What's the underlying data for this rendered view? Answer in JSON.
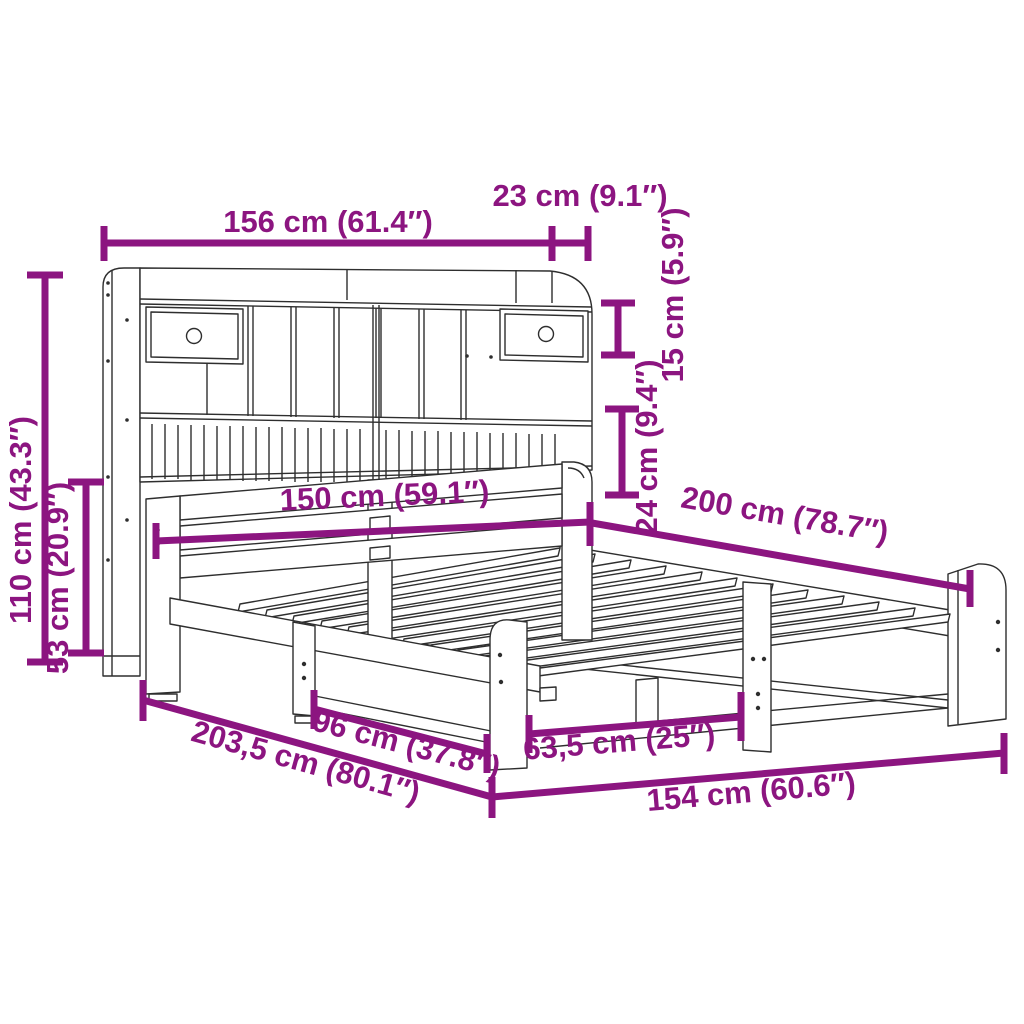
{
  "colors": {
    "accent": "#8C1580",
    "line_art": "#2E2E2E",
    "background": "#FFFFFF"
  },
  "diagram": {
    "dimensions": {
      "headboard_width": {
        "label": "156 cm (61.4″)"
      },
      "headboard_top_depth": {
        "label": "23 cm (9.1″)"
      },
      "top_shelf_height": {
        "label": "15 cm (5.9″)"
      },
      "mid_shelf_height": {
        "label": "24 cm (9.4″)"
      },
      "total_height": {
        "label": "110 cm (43.3″)"
      },
      "lower_height": {
        "label": "53 cm (20.9″)"
      },
      "bed_width": {
        "label": "150 cm (59.1″)"
      },
      "bed_length": {
        "label": "200 cm (78.7″)"
      },
      "total_length": {
        "label": "203,5 cm (80.1″)"
      },
      "leg_spacing": {
        "label": "96 cm (37.8″)"
      },
      "center_support_spacing": {
        "label": "63,5 cm (25″)"
      },
      "frame_width": {
        "label": "154 cm (60.6″)"
      }
    }
  }
}
